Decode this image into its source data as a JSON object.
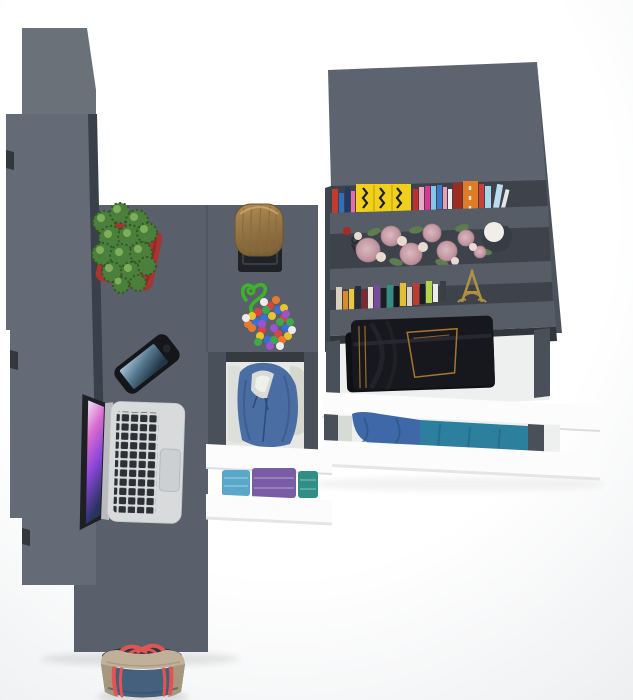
{
  "scene": {
    "description": "Top-down 3D render of a grey corner desk with wardrobe, bookshelf and open white drawers filled with clothes",
    "depicted_objects": [
      "wardrobe",
      "corner-desk",
      "bookshelf-unit",
      "open-drawers",
      "laptop",
      "smartphone",
      "cactus-planter",
      "wood-log-stool",
      "bead-necklace",
      "books",
      "roses",
      "candle-vase",
      "keys",
      "eiffel-tower-figurine",
      "folded-jeans",
      "blue-hoodie",
      "folded-shirts",
      "denim-tote-bag"
    ]
  },
  "palette": {
    "bg_center": "#ffffff",
    "bg_edge": "#eaecee",
    "wardrobe_top": "#6a7179",
    "wardrobe_face": "#646b76",
    "wardrobe_side": "#3a4049",
    "wardrobe_handle": "#33383f",
    "desk": "#59606b",
    "desk_seam": "#4b525b",
    "unit_top": "#5d6470",
    "shelf_front": "#565d67",
    "shelf_cavity": "#3d424b",
    "cavity_lip": "#31353c",
    "unit_side": "#4c525c",
    "unit_edge": "#3f454e",
    "rail": "#4a505a",
    "drawer_interior": "#eef0f0",
    "drawer_front": "#fcfcfd",
    "front_shadow": "#dcdee0",
    "mid_lip": "#363b42",
    "mid_interior": "#e7e8e5"
  },
  "objects": {
    "laptop": {
      "body": "#d8dadc",
      "keys": "#2d3034",
      "trackpad": "#cdd0d3",
      "hinge": "#b9bbbe",
      "lid": "#1e2024",
      "screen": [
        "#efe6f2",
        "#d86ad0",
        "#8a46d8",
        "#273360"
      ]
    },
    "phone": {
      "body": "#14161a",
      "button": "#23262b",
      "screen": [
        "#a9c3d4",
        "#55788f",
        "#233646"
      ]
    },
    "plant": {
      "pot": "#a83531",
      "pot_dark": "#8c2b27",
      "leaf": "#4a7f3c",
      "leaf_dark": "#30591f",
      "leaf_light": "#7fae5b"
    },
    "stool": {
      "wood": "#b08b55",
      "wood_dark": "#7d6136",
      "streak": "#8a6a3e",
      "base": "#1f2226",
      "base_line": "#3a3e44"
    },
    "beads": {
      "cord": "#3db32a",
      "palette": [
        "#d84343",
        "#3a6fd8",
        "#e8c32e",
        "#3da84a",
        "#9a54d0",
        "#e87a2e",
        "#ececec"
      ]
    },
    "books_top": [
      "#c23b2f",
      "#2f6fc0",
      "#223a66",
      "#e06fa8",
      "#f0d01a",
      "#c03028",
      "#e8a8c8",
      "#d83890",
      "#88c4e8",
      "#3a7bd0",
      "#e8a0b8",
      "#ececee",
      "#9e2a22",
      "#e07b28",
      "#c84038",
      "#a8d4ec",
      "#bcdcf0",
      "#e4e6e8"
    ],
    "yellow_book_text": "#1c1c1c",
    "orange_book_text": "#f2ead8",
    "books_bottom": [
      "#d8cfc0",
      "#d98b2b",
      "#e8c93a",
      "#2a2d33",
      "#8a2430",
      "#eae6de",
      "#7a4a9e",
      "#1c1e24",
      "#2f8f85",
      "#14161a",
      "#e0bf35",
      "#d8d4cc",
      "#c03a30",
      "#1a1c20",
      "#b3d44a",
      "#ecece8",
      "#3a3e46"
    ],
    "flowers": {
      "rose_light": "#dbb8c0",
      "rose": "#c49aa5",
      "rose_edge": "#ae8490",
      "bud": "#e8dacf",
      "leaf": "#5d7d4f",
      "vase": "#383d45",
      "candle": "#f0eee8",
      "key": "#2a2d33",
      "berry": "#a82a28"
    },
    "eiffel": "#b3913f",
    "jeans": {
      "denim": "#17181d",
      "under": "#0f1013",
      "fold": "#2a2c33",
      "stitch": "#a8742f"
    },
    "hoodie": {
      "main": "#4a6da4",
      "shade": "#3a5788",
      "lining": "#d8dcd4",
      "inner": "#eef0ea",
      "cloth": "#dde0da",
      "cloth2": "#d6d8d0",
      "cord": "#2e4a78"
    },
    "folded": [
      "#5aa8c9",
      "#7a5ca6",
      "#2f8f85",
      "#8fc0b0"
    ],
    "drawer2": {
      "hoodie": "#3e68a8",
      "shirt": "#2d7f9e",
      "cloth": "#d8dbd5",
      "shade": "#27557e"
    },
    "bag": {
      "denim": "#45607c",
      "denim_dark": "#35506a",
      "trim": "#c0b09a",
      "trim_dark": "#a8977f",
      "handle": "#e05552",
      "interior": "#2c3844"
    }
  }
}
